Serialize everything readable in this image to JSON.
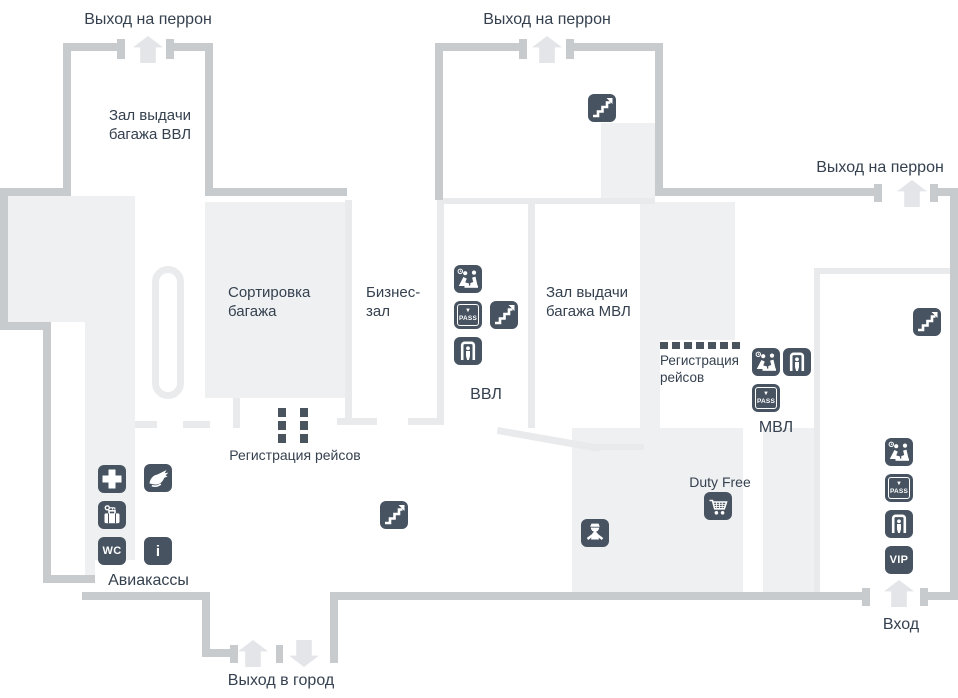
{
  "map": {
    "title_implicit": "Схема терминала аэропорта",
    "labels": {
      "exit_platform": "Выход на перрон",
      "baggage_vvl_l1": "Зал выдачи",
      "baggage_vvl_l2": "багажа ВВЛ",
      "sorting_l1": "Сортировка",
      "sorting_l2": "багажа",
      "business_l1": "Бизнес-",
      "business_l2": "зал",
      "baggage_mvl_l1": "Зал выдачи",
      "baggage_mvl_l2": "багажа МВЛ",
      "vvl": "ВВЛ",
      "mvl": "МВЛ",
      "checkin_line": "Регистрация рейсов",
      "checkin_l1": "Регистрация",
      "checkin_l2": "рейсов",
      "duty_free": "Duty Free",
      "ticket_office": "Авиакассы",
      "exit_city": "Выход в город",
      "entrance": "Вход",
      "pass": "PASS",
      "vip": "VIP",
      "wc": "WC",
      "info": "i",
      "pass_arrow": "▼"
    },
    "icon_names": {
      "stairs": "stairs-icon",
      "customs": "customs-control-icon",
      "pass": "pass-control-icon",
      "detector": "security-screening-icon",
      "medical": "first-aid-icon",
      "hand": "hand-service-icon",
      "luggage": "luggage-storage-icon",
      "wc": "wc-icon",
      "info": "info-icon",
      "vip": "vip-lounge-icon",
      "cart": "duty-free-shop-icon",
      "police": "police-post-icon",
      "door_arrow": "door-direction-arrow"
    },
    "colors": {
      "outer_wall": "#c8cbce",
      "inner_wall": "#e8eaec",
      "zone_fill": "#eff0f2",
      "icon_bg": "#475361",
      "text": "#35414f",
      "arrow": "#e3e5e8",
      "background": "#ffffff"
    }
  }
}
